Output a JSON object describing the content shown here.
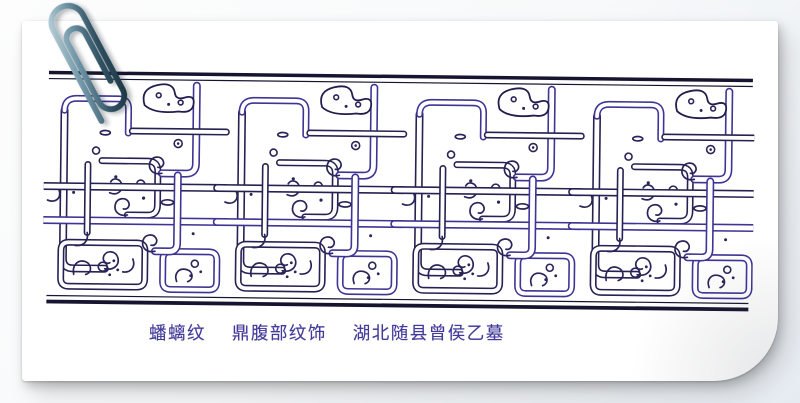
{
  "card": {
    "caption": {
      "pattern_name": "蟠螭纹",
      "object_part": "鼎腹部纹饰",
      "provenance": "湖北随县曾侯乙墓"
    },
    "artwork": {
      "ink_color": "#262152",
      "accent_color": "#3e3494"
    },
    "paperclip_color": "#2f4f61"
  }
}
